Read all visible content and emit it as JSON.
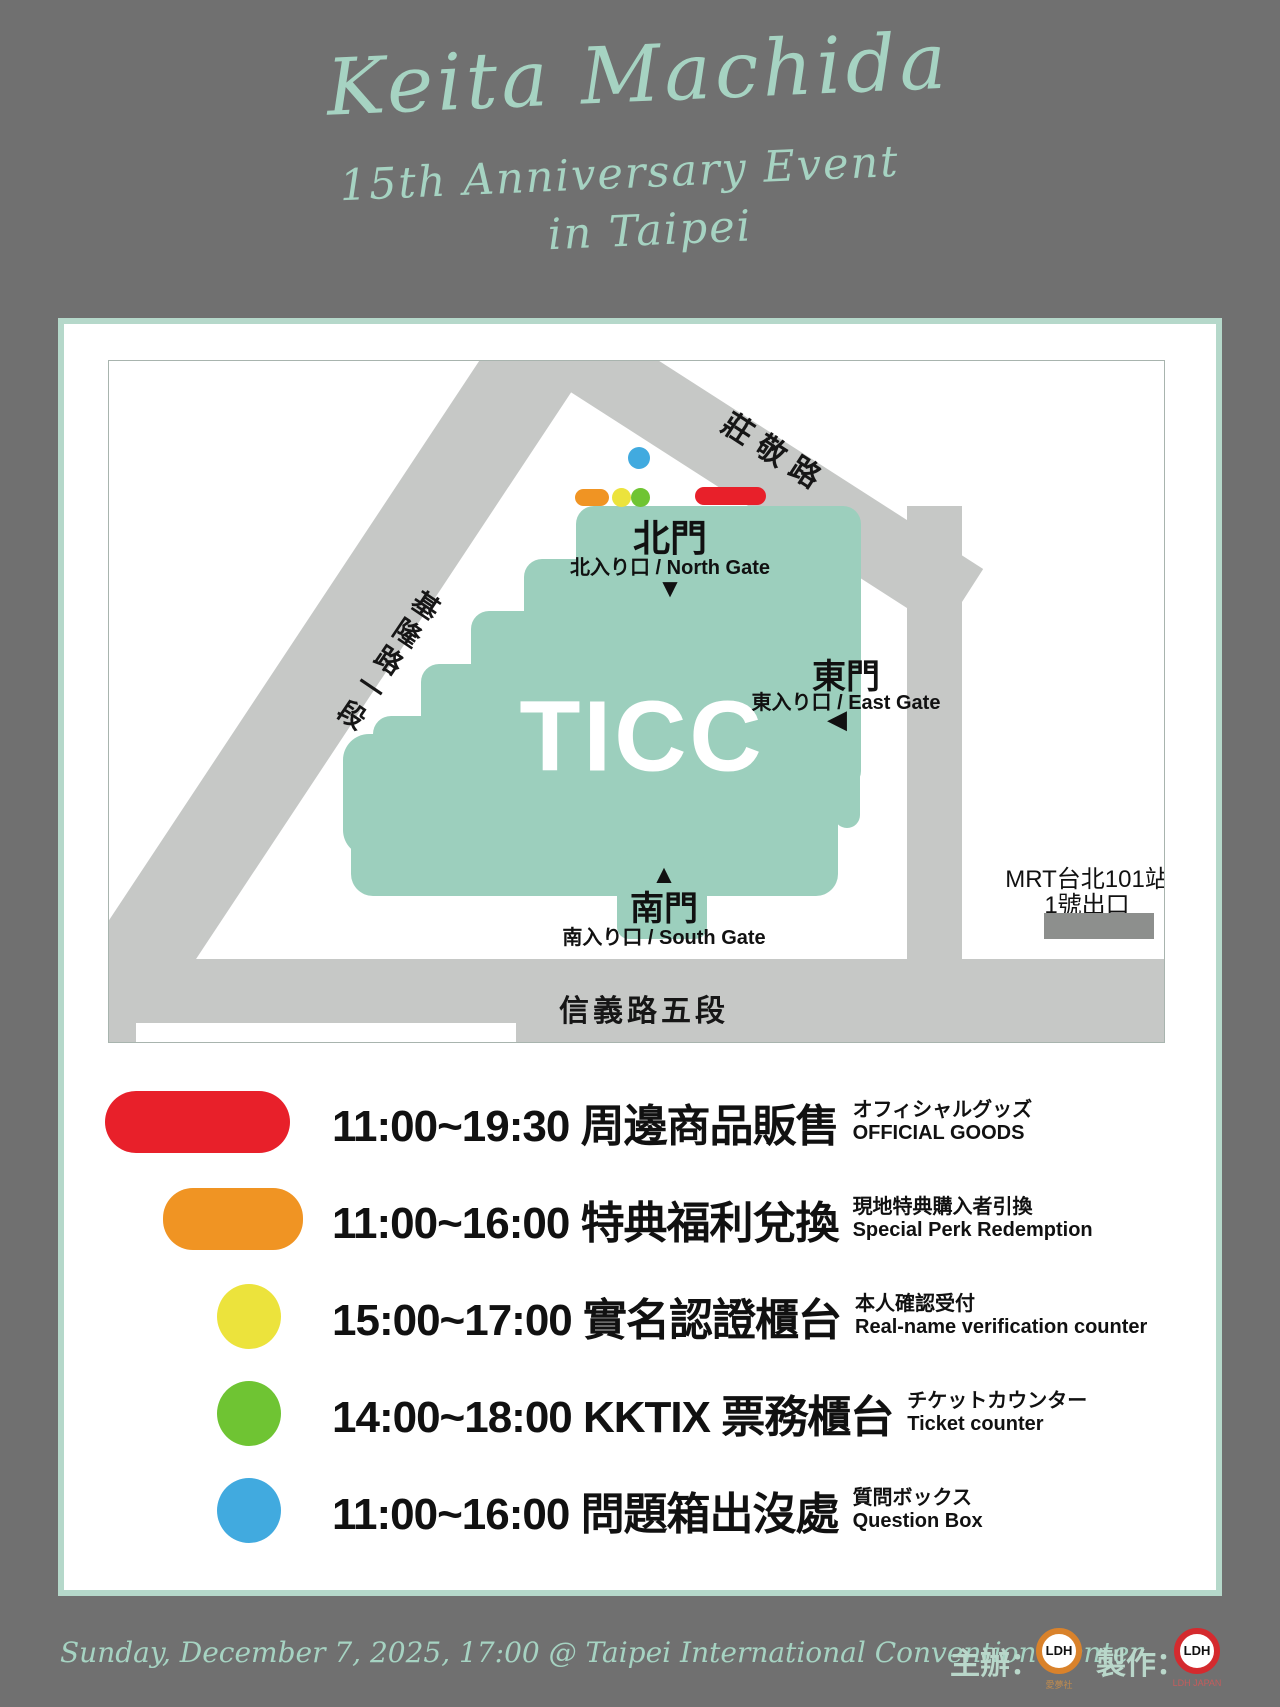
{
  "title": {
    "line1": "Keita Machida",
    "line2": "15th Anniversary Event",
    "line3": "in Taipei"
  },
  "map": {
    "venue_label": "TICC",
    "roads": {
      "northeast": "莊敬路",
      "west": "基隆路一段",
      "south": "信義路五段"
    },
    "gates": {
      "north": {
        "name": "北門",
        "sub": "北入り口 / North Gate"
      },
      "east": {
        "name": "東門",
        "sub": "東入り口 / East Gate"
      },
      "south": {
        "name": "南門",
        "sub": "南入り口 / South Gate"
      }
    },
    "mrt": {
      "line1": "MRT台北101站",
      "line2": "1號出口"
    },
    "icons": {
      "down_triangle": "▼",
      "up_triangle": "▲",
      "left_triangle": "◀"
    }
  },
  "legend": {
    "rows": [
      {
        "marker": "red-pill",
        "color": "#e8202a",
        "time_title": "11:00~19:30 周邊商品販售",
        "note1": "オフィシャルグッズ",
        "note2": "OFFICIAL GOODS"
      },
      {
        "marker": "orange-pill",
        "color": "#f09423",
        "time_title": "11:00~16:00 特典福利兌換",
        "note1": "現地特典購入者引換",
        "note2": "Special Perk Redemption"
      },
      {
        "marker": "yellow-circle",
        "color": "#ece33c",
        "time_title": "15:00~17:00 實名認證櫃台",
        "note1": "本人確認受付",
        "note2": "Real-name verification counter"
      },
      {
        "marker": "green-circle",
        "color": "#6fc433",
        "time_title": "14:00~18:00 KKTIX 票務櫃台",
        "note1": "チケットカウンター",
        "note2": "Ticket counter"
      },
      {
        "marker": "blue-circle",
        "color": "#41aadf",
        "time_title": "11:00~16:00 問題箱出沒處",
        "note1": "質問ボックス",
        "note2": "Question Box"
      }
    ]
  },
  "footer": {
    "schedule": "Sunday, December 7, 2025, 17:00  @ Taipei International Convention Center",
    "organizer_label": "主辦：",
    "producer_label": "製作：",
    "logo_text": "LDH",
    "organizer_logo_caption": "愛夢社",
    "producer_logo_caption": "LDH JAPAN"
  },
  "colors": {
    "background": "#707070",
    "card_border": "#b5d8ca",
    "building": "#9ccfbd",
    "road": "#c6c8c6",
    "mrt_block": "#8d8f8d",
    "title_text": "#a6d3c2",
    "red": "#e8202a",
    "orange": "#f09423",
    "yellow": "#ece33c",
    "green": "#6fc433",
    "blue": "#41aadf"
  }
}
